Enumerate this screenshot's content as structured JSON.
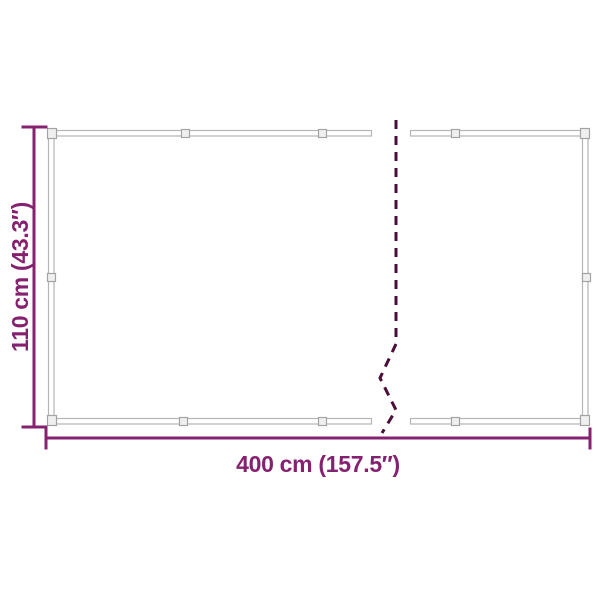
{
  "dimensions": {
    "width": {
      "label": "400 cm (157.5″)"
    },
    "height": {
      "label": "110 cm (43.3″)"
    }
  },
  "colors": {
    "accent_purple": "#862170",
    "break_line_purple": "#4a0e38",
    "frame_gray": "#b5b5b5",
    "grommet_fill": "#efefef",
    "background": "#ffffff"
  }
}
